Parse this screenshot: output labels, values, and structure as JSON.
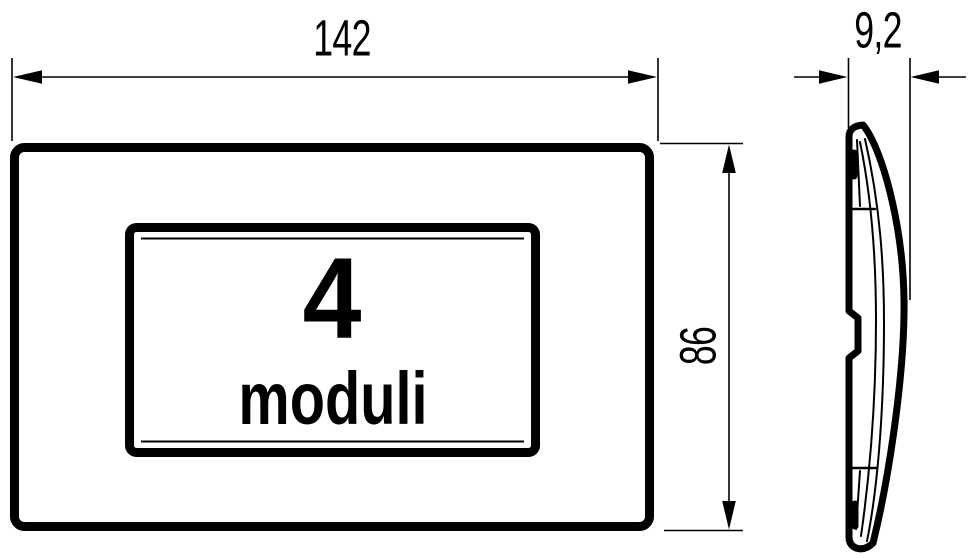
{
  "drawing": {
    "kind": "technical-dimension-drawing",
    "subject": "4-module rectangular cover plate, front view and side profile"
  },
  "dimensions": {
    "width_label": "142",
    "height_label": "86",
    "depth_label": "9,2"
  },
  "plate": {
    "module_count": "4",
    "module_label": "moduli"
  },
  "colors": {
    "line": "#000000",
    "background": "#ffffff"
  }
}
